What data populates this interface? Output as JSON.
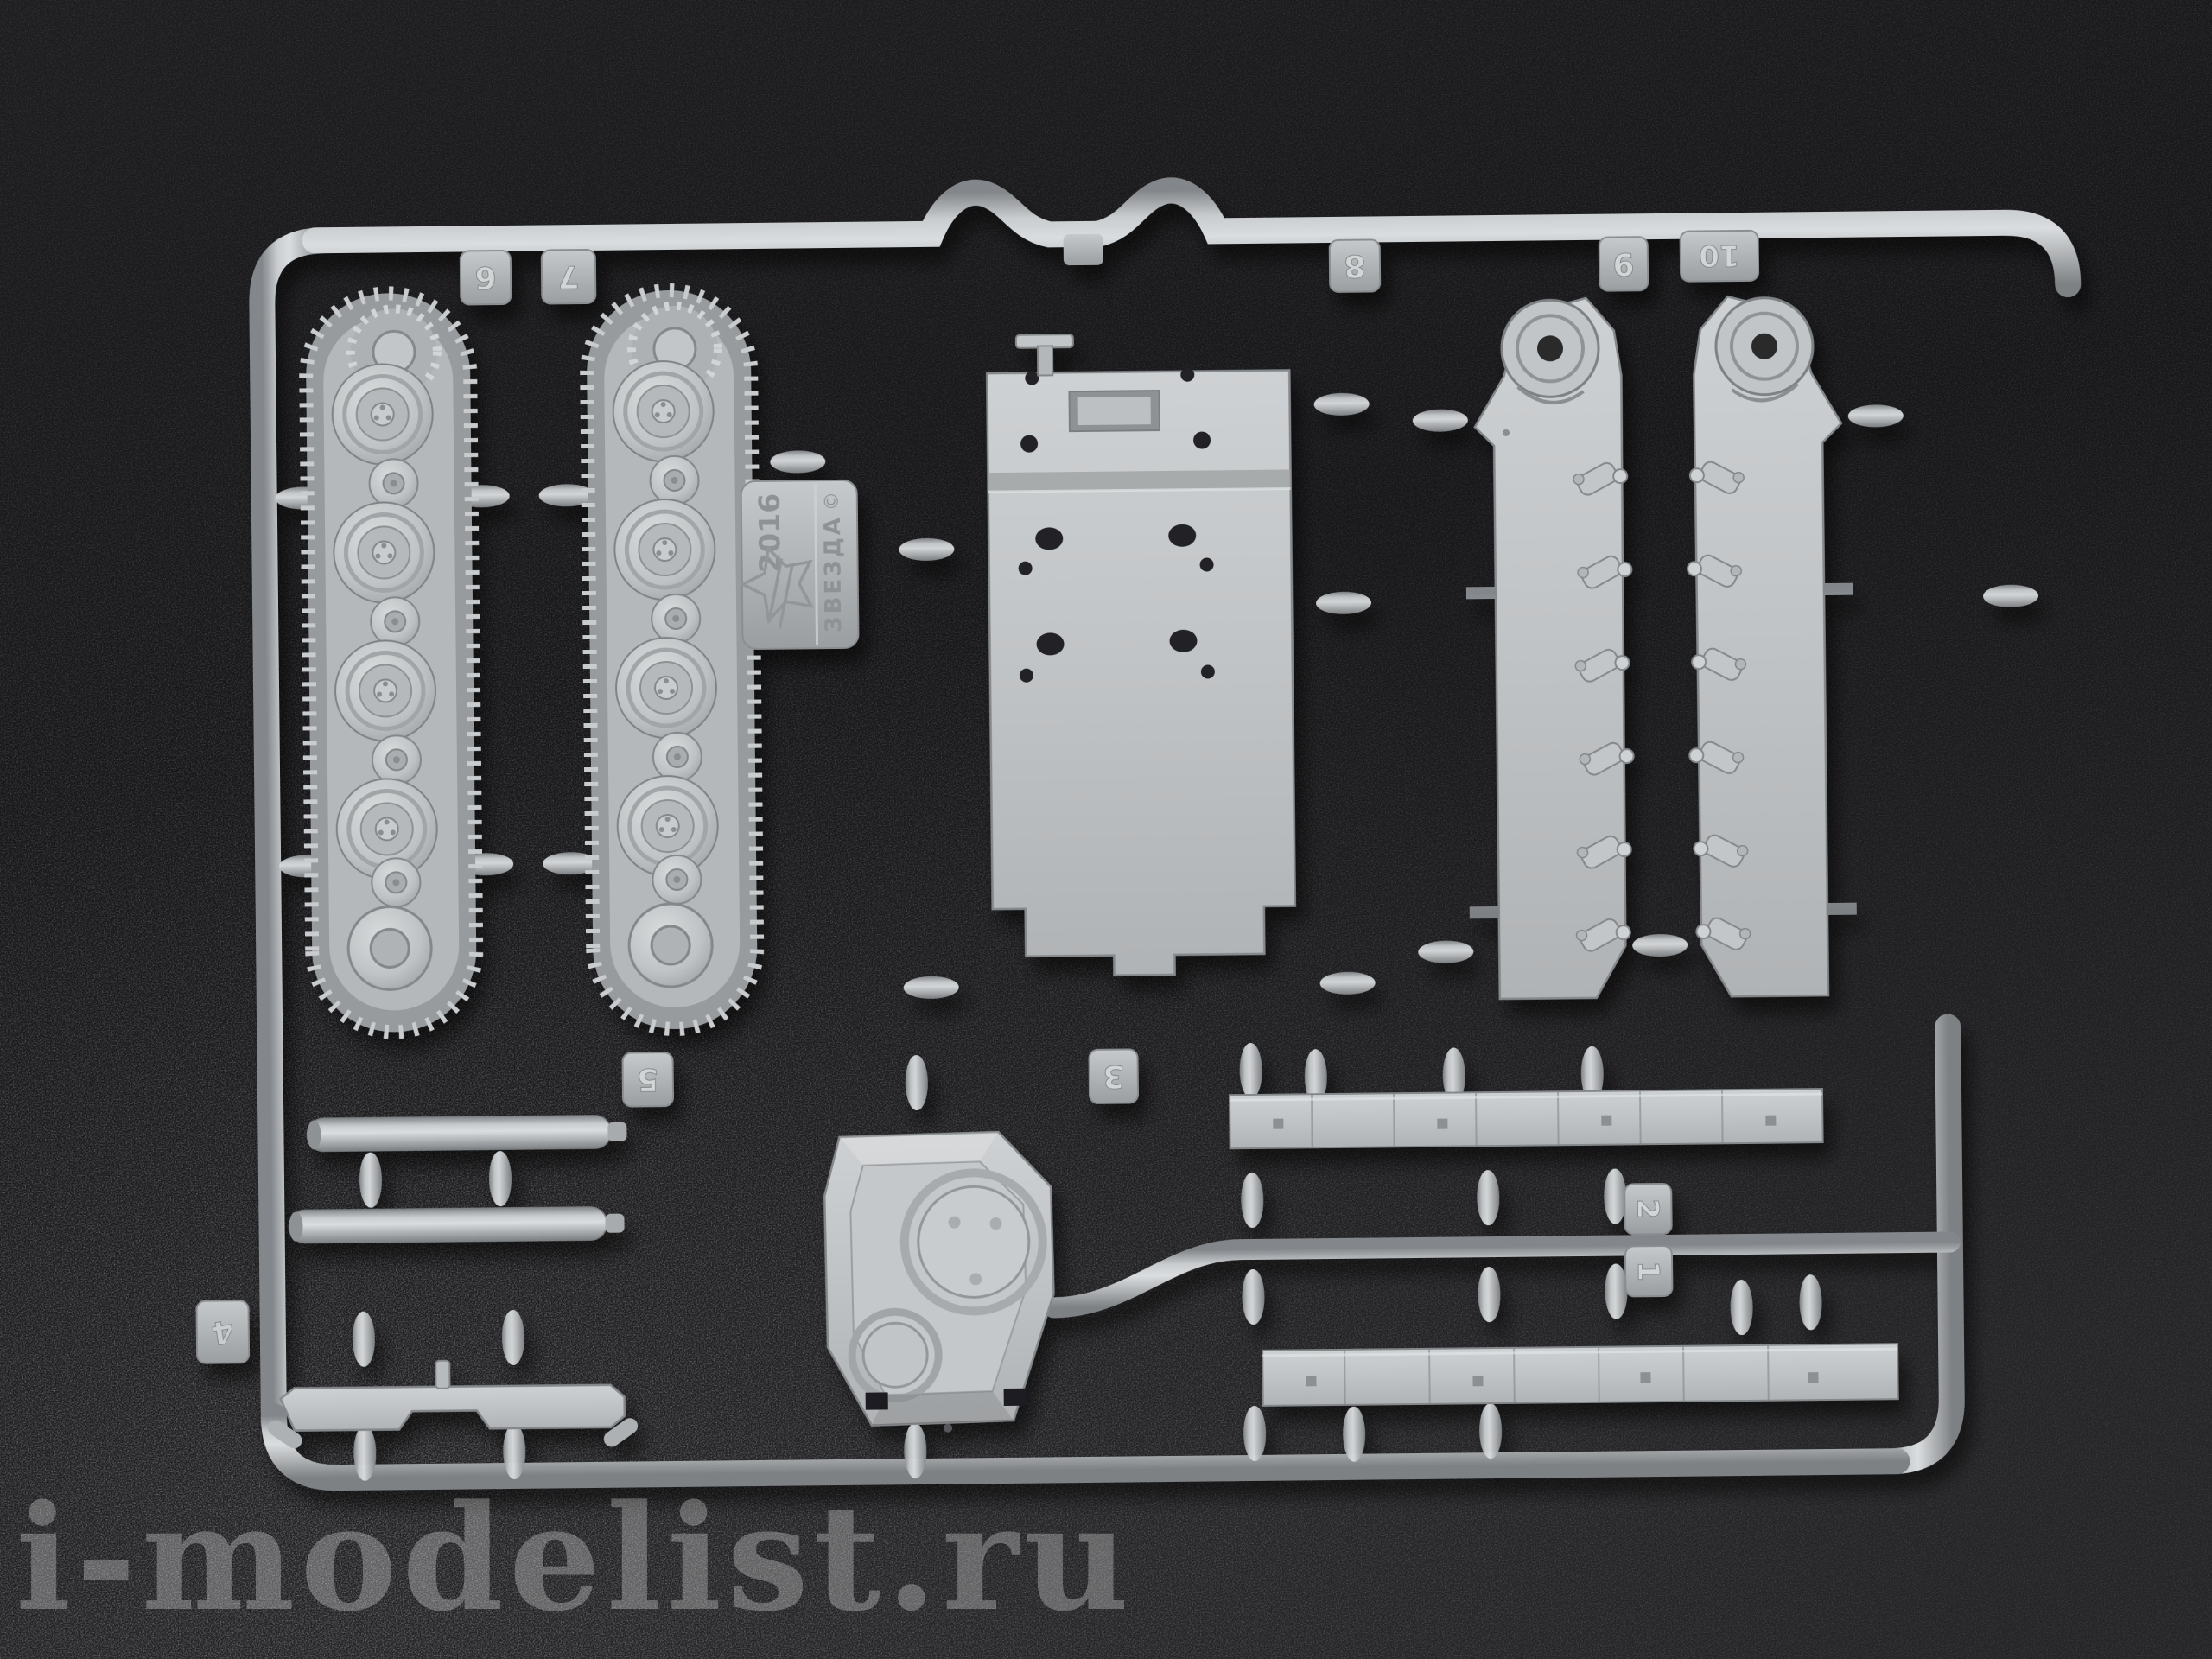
{
  "photo": {
    "description": "gray injection-molded plastic model kit sprue on dark textured background",
    "colors": {
      "background": "#19191b",
      "plastic": "#b4b7b9",
      "plastic_light": "#d8dbdc",
      "plastic_dark": "#85888b",
      "watermark": "#ffffff"
    },
    "watermark": {
      "text": "i-modelist.ru"
    },
    "mold_tag": {
      "year": "2016",
      "brand": "ЗВЕЗДА",
      "copyright_symbol": "©"
    },
    "tabs": {
      "t1": {
        "label": "1"
      },
      "t2": {
        "label": "2"
      },
      "t3": {
        "label": "3"
      },
      "t4": {
        "label": "4"
      },
      "t5": {
        "label": "5"
      },
      "t6": {
        "label": "6"
      },
      "t7": {
        "label": "7"
      },
      "t8": {
        "label": "8"
      },
      "t9": {
        "label": "9"
      },
      "t10": {
        "label": "10"
      }
    },
    "parts": [
      {
        "name": "track-and-roadwheel-assembly",
        "count": 2
      },
      {
        "name": "hull-plate",
        "count": 1
      },
      {
        "name": "hull-side-panel-with-suspension",
        "count": 2
      },
      {
        "name": "turret-shell",
        "count": 1
      },
      {
        "name": "axle-rod",
        "count": 2
      },
      {
        "name": "suspension-cross-bracket",
        "count": 1
      },
      {
        "name": "fender-strip",
        "count": 2
      }
    ]
  }
}
